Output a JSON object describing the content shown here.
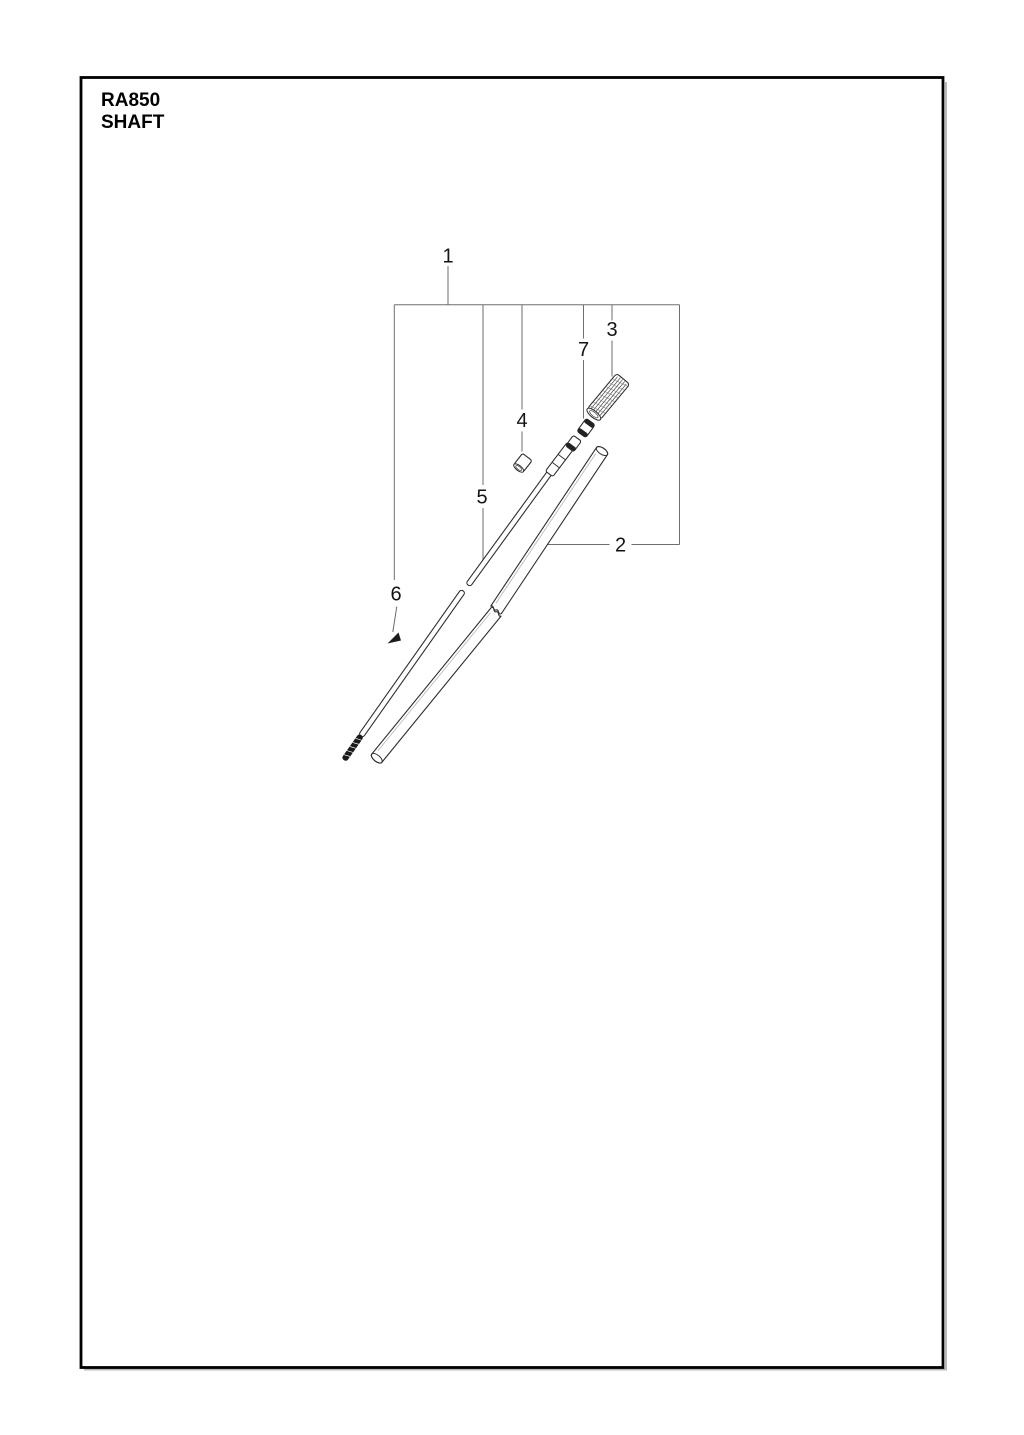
{
  "page": {
    "model": "RA850",
    "section": "SHAFT"
  },
  "diagram": {
    "type": "exploded_parts_diagram",
    "callout_labels": [
      "1",
      "2",
      "3",
      "4",
      "5",
      "6",
      "7"
    ]
  },
  "colors": {
    "background": "#ffffff",
    "border": "#000000",
    "leader_line": "#6e6e6e",
    "part_line": "#2e2e2e",
    "text": "#141414"
  }
}
